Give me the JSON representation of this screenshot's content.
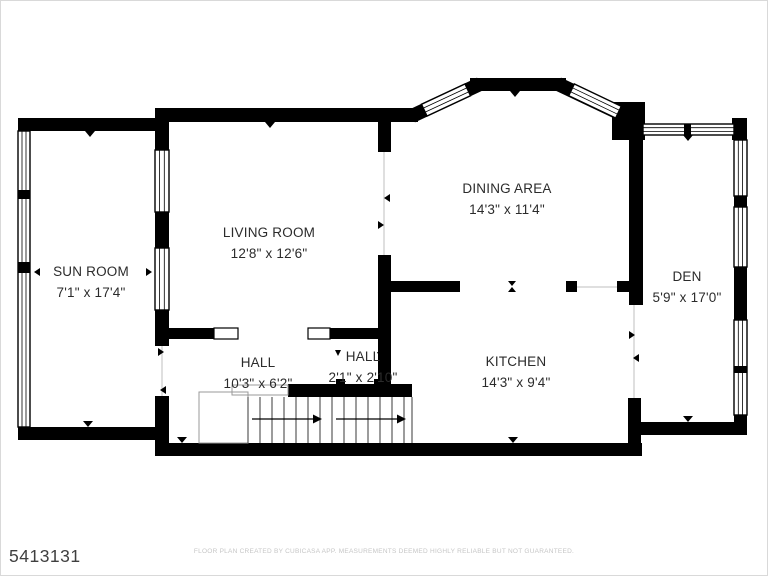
{
  "page": {
    "plan_number": "5413131",
    "footer": "FLOOR PLAN CREATED BY CUBICASA APP. MEASUREMENTS DEEMED HIGHLY RELIABLE BUT NOT GUARANTEED."
  },
  "rooms": [
    {
      "name": "SUN ROOM",
      "dimensions": "7'1\" x 17'4\""
    },
    {
      "name": "LIVING ROOM",
      "dimensions": "12'8\" x 12'6\""
    },
    {
      "name": "DINING AREA",
      "dimensions": "14'3\" x 11'4\""
    },
    {
      "name": "DEN",
      "dimensions": "5'9\" x 17'0\""
    },
    {
      "name": "HALL",
      "dimensions": "10'3\" x 6'2\""
    },
    {
      "name": "HALL",
      "dimensions": "2'1\" x 2'10\""
    },
    {
      "name": "KITCHEN",
      "dimensions": "14'3\" x 9'4\""
    }
  ],
  "colors": {
    "wall": "#000000",
    "label_text": "#2b2b2b",
    "plan_number_text": "#3f3f3f",
    "footer_text": "#c6c6c6"
  }
}
